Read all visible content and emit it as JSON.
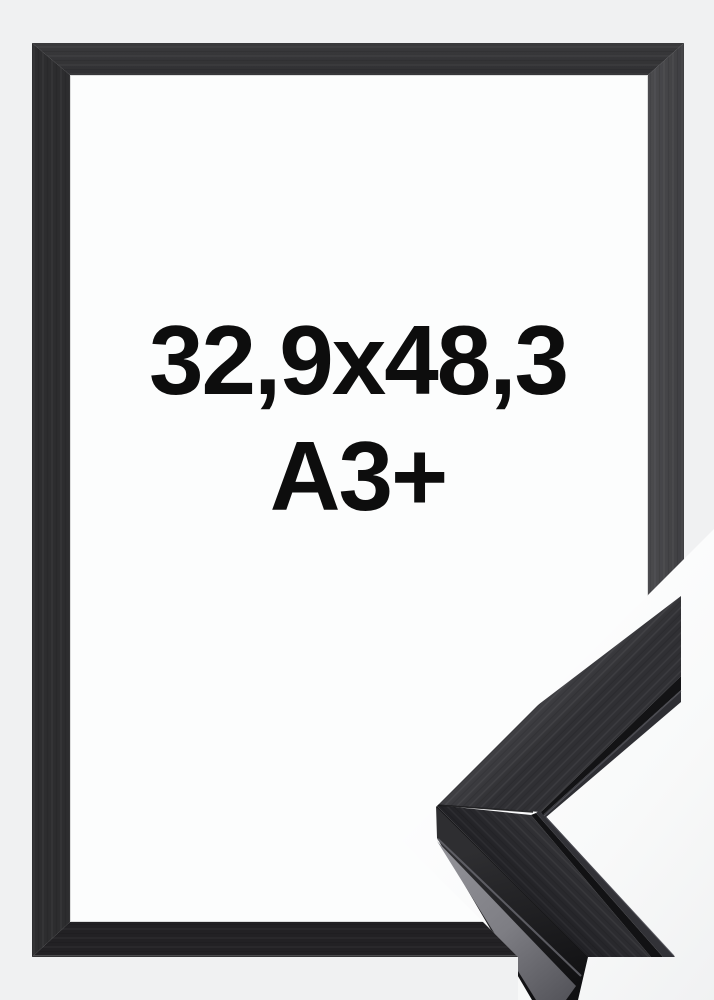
{
  "frame_preview": {
    "size_text": "32,9x48,3",
    "format_text": "A3+"
  },
  "colors": {
    "page_background": "#f0f1f2",
    "frame_top": "#353538",
    "frame_right": "#464649",
    "frame_bottom": "#222124",
    "frame_left": "#2d2d2f",
    "opening_white": "#fcfdfd",
    "text": "#0d0d0d",
    "detail_wood_upper": "#3d3d41",
    "detail_wood_lower": "#2a2a2d",
    "detail_side_gray": "#7e7e84"
  }
}
